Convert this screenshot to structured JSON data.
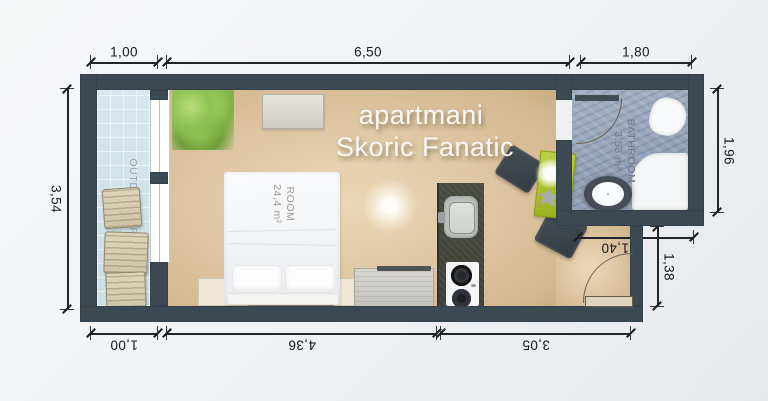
{
  "watermark": {
    "line1": "apartmani",
    "line2": "Skoric Fanatic"
  },
  "rooms": {
    "main": {
      "name": "ROOM",
      "area": "24,4 m²"
    },
    "bathroom": {
      "name": "BATHROOM",
      "area": "3,53 m²"
    },
    "outdoor": {
      "name": "OUTDOOR SPACE",
      "area": "3,54 m²"
    }
  },
  "dimensions": {
    "top_outdoor": "1,00",
    "top_room": "6,50",
    "top_bathroom": "1,80",
    "left_height": "3,54",
    "right_bathroom_height": "1,96",
    "right_entry_height": "1,38",
    "bathroom_width_inner": "1,40",
    "bottom_outdoor": "1,00",
    "bottom_room": "4,36",
    "bottom_kitchen": "3,05"
  },
  "colors": {
    "wall": "#3c4953",
    "room_floor": "#dfc7a4",
    "outdoor_floor": "#d4e5ec",
    "bathroom_floor": "#9aa9bc",
    "kitchen_counter": "#43463c",
    "dining_table": "#a9c22e",
    "dimension_text": "#1d2126",
    "watermark_text": "#ffffff"
  }
}
